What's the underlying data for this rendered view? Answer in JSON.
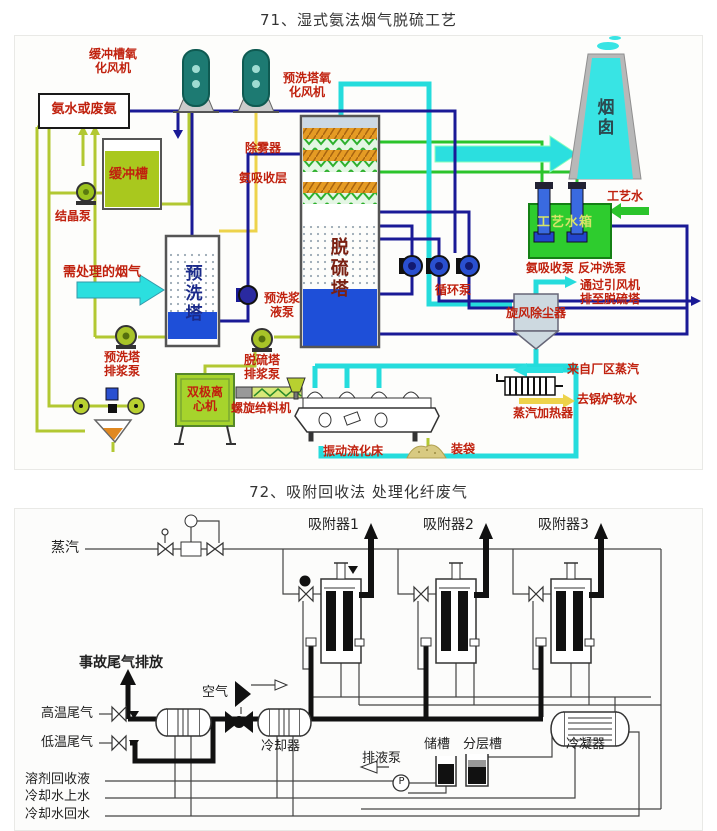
{
  "page": {
    "title1": "71、湿式氨法烟气脱硫工艺",
    "title2": "72、吸附回收法 处理化纤废气"
  },
  "colors": {
    "label_red": "#c0210e",
    "pipe_lime": "#b2c832",
    "pipe_yellow": "#edd34b",
    "pipe_navy": "#1a1a96",
    "pipe_cyan": "#25dcdc",
    "pipe_green": "#2bc42b",
    "tank_green_fill": "#a9c81e",
    "bright_green_tank": "#2ecc2e",
    "tower_blue": "#1e4fd8",
    "chimney_cyan": "#38e4e4",
    "vessel_teal": "#1d7a72",
    "diagram2_line": "#333333"
  },
  "figure1": {
    "labels": {
      "buffer_fan": "缓冲槽氧\n化风机",
      "ammonia_feed": "氨水或废氨",
      "prewash_fan": "预洗塔氧\n化风机",
      "buffer_tank": "缓冲槽",
      "crystal_pump": "结晶泵",
      "demister": "除雾器",
      "ammonia_layer": "氨吸收层",
      "flue_gas_in": "需处理的烟气",
      "prewash_tower": "预洗塔",
      "desulf_tower": "脱硫塔",
      "prewash_slurry_pump": "预洗浆\n液泵",
      "circulation_pump": "循环泵",
      "chimney": "烟囱",
      "process_water": "工艺水",
      "process_water_tank": "工艺水箱",
      "absorb_pumps": "氨吸收泵 反冲洗泵",
      "via_fan": "通过引风机\n排至脱硫塔",
      "cyclone": "旋风除尘器",
      "plant_steam": "来自厂区蒸汽",
      "boiler_water": "去锅炉软水",
      "steam_heater": "蒸汽加热器",
      "prewash_drain_pump": "预洗塔\n排浆泵",
      "desulf_drain_pump": "脱硫塔\n排浆泵",
      "centrifuge": "双极离\n心机",
      "screw_feeder": "螺旋给料机",
      "vibrating_bed": "振动流化床",
      "bagging": "装袋"
    }
  },
  "figure2": {
    "labels": {
      "steam": "蒸汽",
      "adsorber1": "吸附器1",
      "adsorber2": "吸附器2",
      "adsorber3": "吸附器3",
      "accident_vent": "事故尾气排放",
      "high_temp_gas": "高温尾气",
      "low_temp_gas": "低温尾气",
      "air": "空气",
      "cooler": "冷却器",
      "solvent_recovery": "溶剂回收液",
      "cooling_supply": "冷却水上水",
      "cooling_return": "冷却水回水",
      "drain_pump": "排液泵",
      "pump_symbol": "P",
      "storage_tank": "储槽",
      "separation_tank": "分层槽",
      "condenser": "冷凝器"
    }
  }
}
